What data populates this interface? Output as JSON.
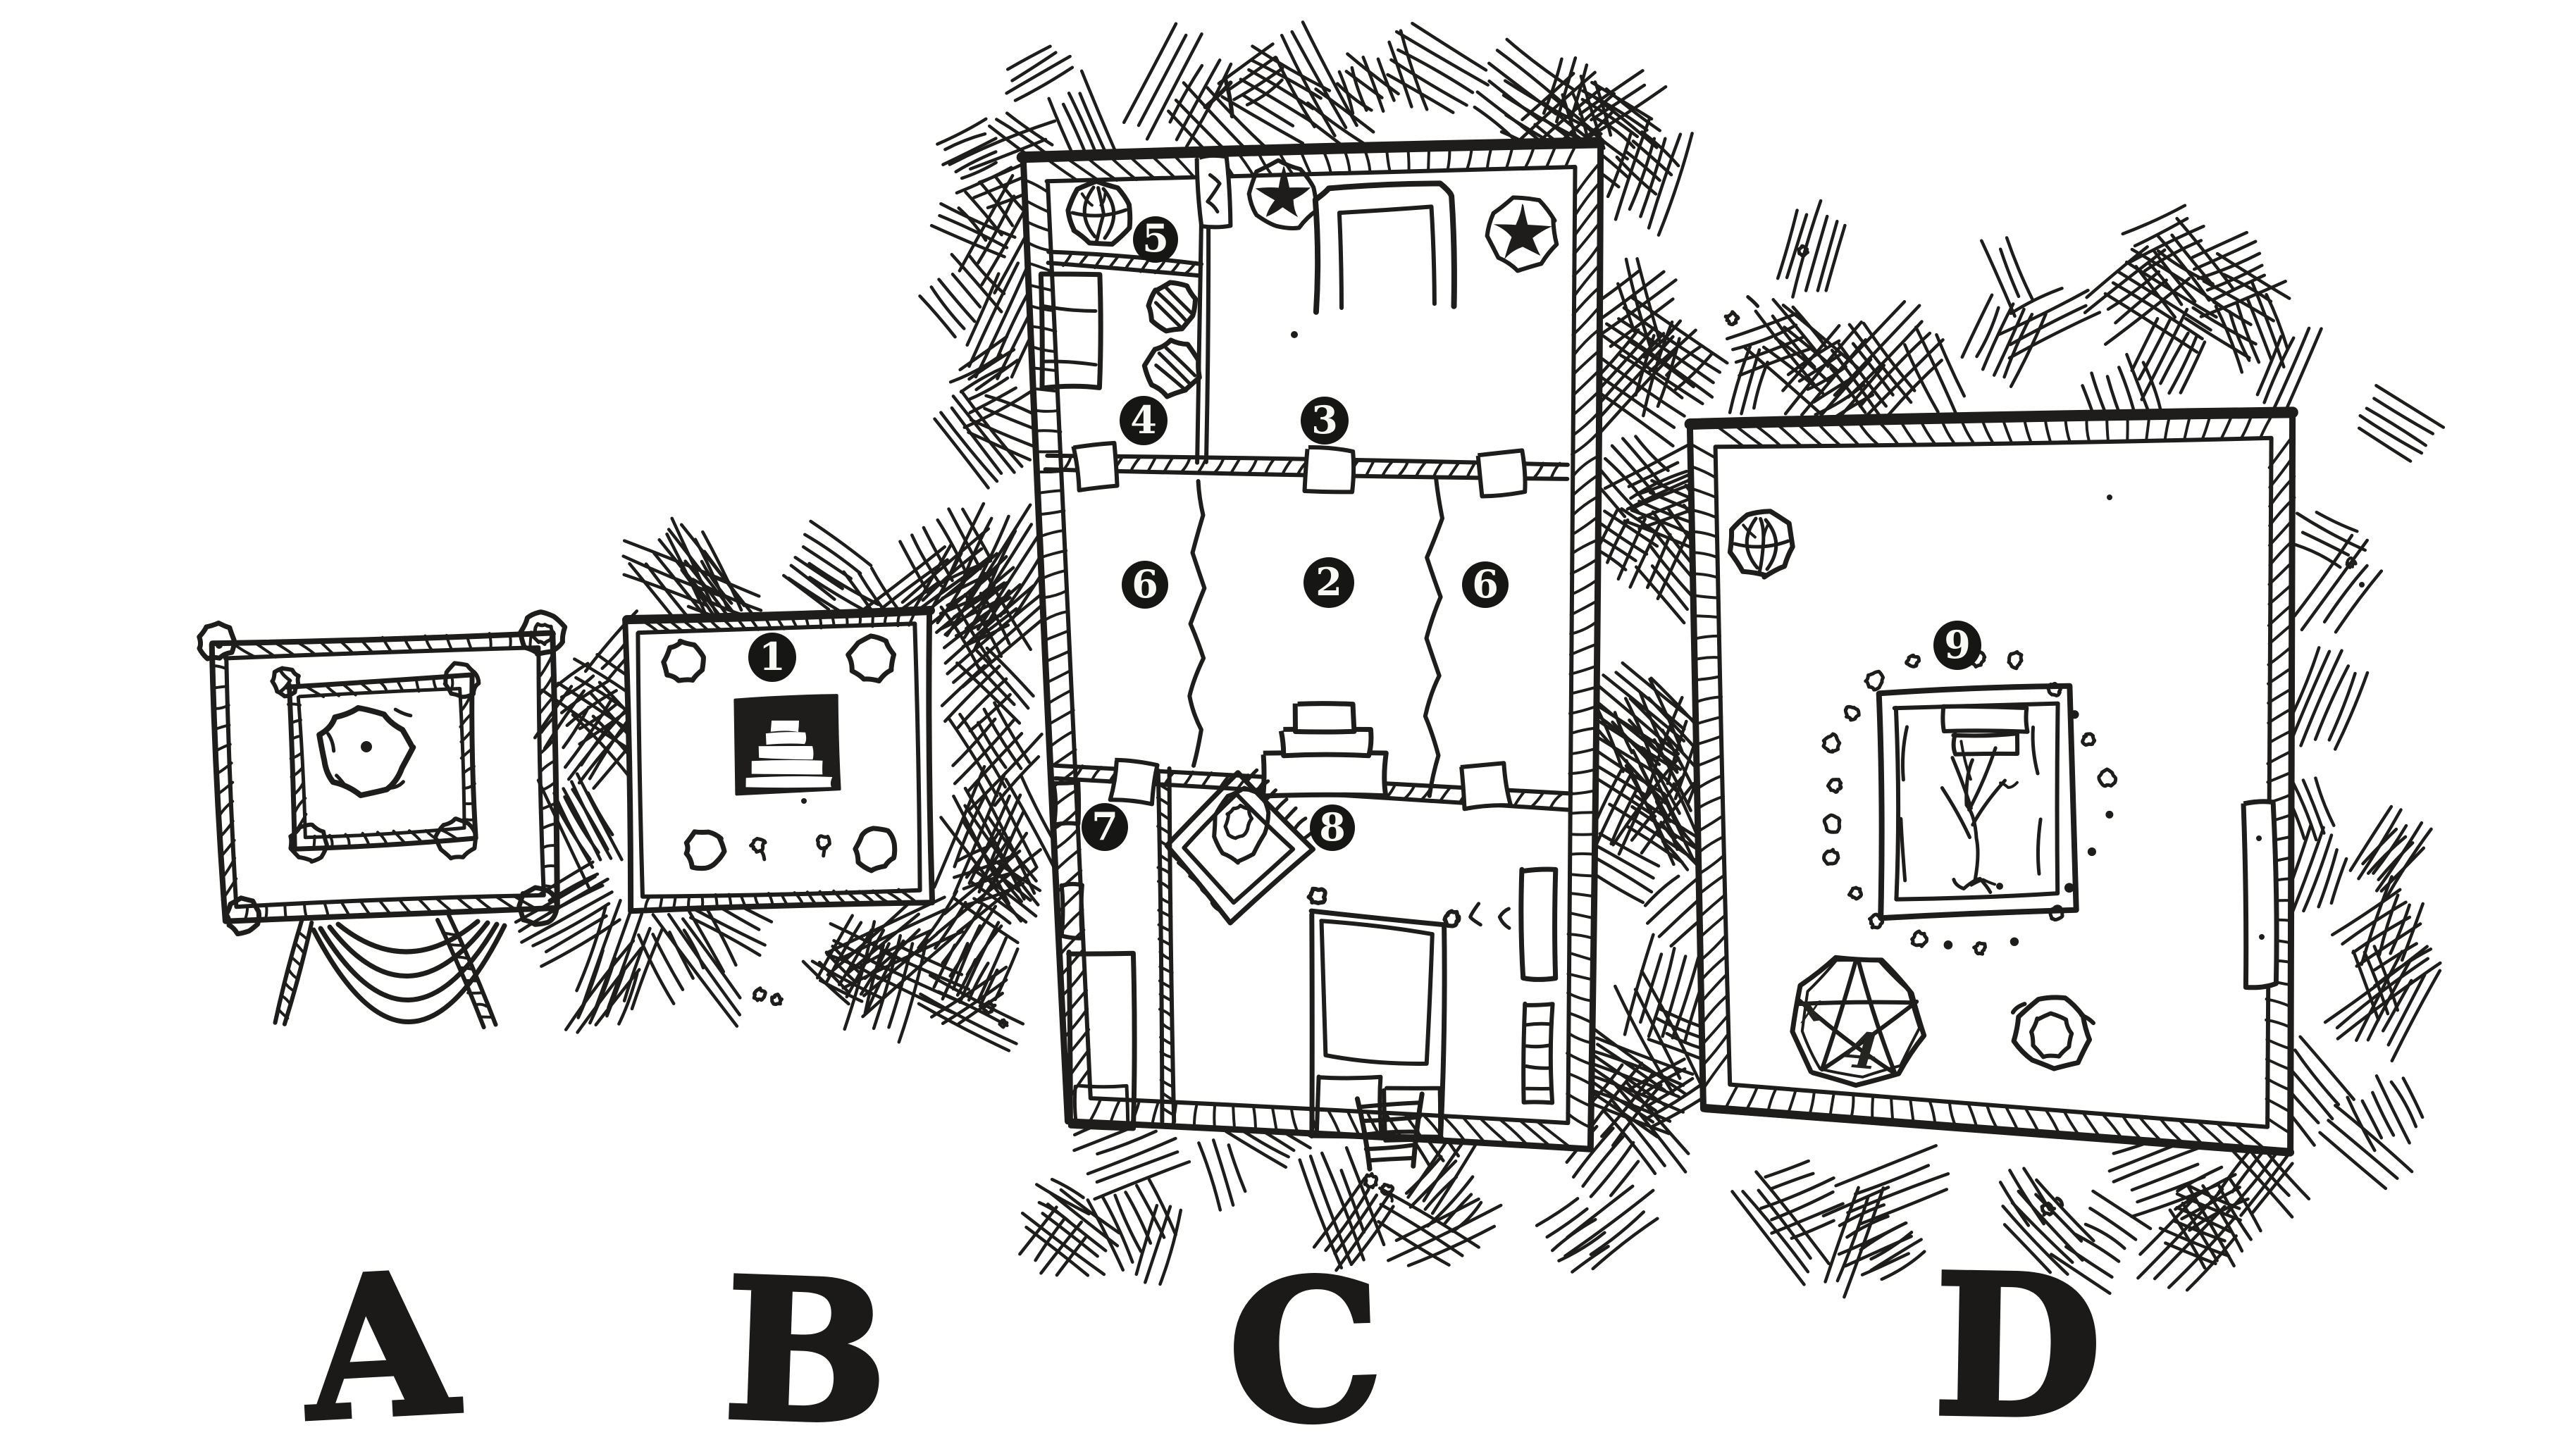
{
  "colors": {
    "ink": "#1e1d1b",
    "paper": "#ffffff",
    "badge_fill": "#161614",
    "badge_text": "#f8f8f5"
  },
  "areas": [
    {
      "id": "A",
      "label": "A"
    },
    {
      "id": "B",
      "label": "B"
    },
    {
      "id": "C",
      "label": "C"
    },
    {
      "id": "D",
      "label": "D"
    }
  ],
  "room_markers": [
    {
      "number": "1",
      "area": "B"
    },
    {
      "number": "2",
      "area": "C"
    },
    {
      "number": "3",
      "area": "C"
    },
    {
      "number": "4",
      "area": "C"
    },
    {
      "number": "5",
      "area": "C"
    },
    {
      "number": "6",
      "area": "C"
    },
    {
      "number": "6",
      "area": "C"
    },
    {
      "number": "7",
      "area": "C"
    },
    {
      "number": "8",
      "area": "C"
    },
    {
      "number": "9",
      "area": "D"
    }
  ],
  "decor": {
    "pentagram_marks": [
      "x",
      "4"
    ]
  }
}
